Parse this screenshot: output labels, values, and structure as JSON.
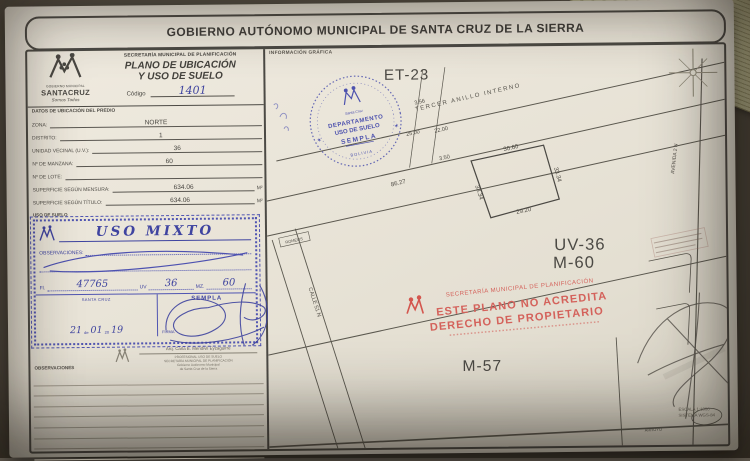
{
  "header": {
    "title": "GOBIERNO AUTÓNOMO MUNICIPAL DE SANTA CRUZ DE LA SIERRA"
  },
  "left": {
    "logo": {
      "org": "GOBIERNO MUNICIPAL",
      "name": "SANTACRUZ",
      "tagline": "Somos Todos"
    },
    "secretary": "SECRETARÍA MUNICIPAL DE PLANIFICACIÓN",
    "title1": "PLANO DE UBICACIÓN",
    "title2": "Y USO DE SUELO",
    "codigo_label": "Código",
    "codigo_value": "1401",
    "datos_label": "DATOS DE UBICACIÓN DEL PREDIO",
    "f_zona_label": "ZONA:",
    "f_zona": "NORTE",
    "f_distrito_label": "DISTRITO:",
    "f_distrito": "1",
    "f_uv_label": "UNIDAD VECINAL (U.V.):",
    "f_uv": "36",
    "f_manzana_label": "Nº DE MANZANA:",
    "f_manzana": "60",
    "f_lote_label": "Nº DE LOTE:",
    "f_lote": "",
    "f_sup_mensura_label": "SUPERFICIE SEGÚN MENSURA:",
    "f_sup_mensura": "634.06",
    "f_sup_mensura_unit": "M²",
    "f_sup_titulo_label": "SUPERFICIE SEGÚN TÍTULO:",
    "f_sup_titulo": "634.06",
    "f_sup_titulo_unit": "M²",
    "uso_label": "USO DE SUELO",
    "stamp": {
      "title": "USO MIXTO",
      "obs_label": "OBSERVACIONES:",
      "fl_label": "Fl.",
      "fl": "47765",
      "uv_label": "UV",
      "uv": "36",
      "mz_label": "MZ.",
      "mz": "60",
      "city": "SANTA CRUZ",
      "office": "SEMPLA",
      "day": "21",
      "de": "de",
      "month": "01",
      "y20": "20",
      "year": "19",
      "firma": "FIRMA"
    },
    "signatory": {
      "name": "Arq. Carla E. Mendivil Eyzaguirre",
      "role": "PROFESIONAL USO DE SUELO",
      "dept": "SECRETARÍA MUNICIPAL DE PLANIFICACIÓN",
      "org1": "Gobierno Autónomo Municipal",
      "org2": "de Santa Cruz de la Sierra"
    },
    "obs_label": "OBSERVACIONES"
  },
  "map": {
    "info_label": "INFORMACIÓN GRÁFICA",
    "et": "ET-23",
    "round_stamp": {
      "l1": "DEPARTAMENTO",
      "l2": "USO DE SUELO",
      "l3": "SEMPLA",
      "l4": "Santa Cruz",
      "l5": "BOLIVIA",
      "star_left": "✶",
      "star_right": "✶"
    },
    "streets": {
      "anillo": "TERCER ANILLO INTERNO",
      "calle": "CALLE 51 N",
      "avenida": "AVENIDA 2 N",
      "ramal": "ROMEOS",
      "arroyo": "ARROYO"
    },
    "blocks": {
      "uv36": "UV-36",
      "m60": "M-60",
      "m57": "M-57"
    },
    "dims": {
      "d356": "3.56",
      "d2500": "25.00",
      "d2200": "22.00",
      "d350": "3.50",
      "d8627": "86.27",
      "p_top": "30.60",
      "p_left": "33.34",
      "p_right": "33.34",
      "p_bottom": "29.20"
    },
    "red_stamp": {
      "arc": "SECRETARÍA MUNICIPAL DE PLANIFICACIÓN",
      "l1": "ESTE PLANO NO ACREDITA",
      "l2": "DERECHO DE PROPIETARIO"
    },
    "scale1": "ESCALA 1:1000",
    "scale2": "SISTEMA WGS-84"
  },
  "colors": {
    "blue_stamp": "#3f44a0",
    "red_stamp": "#d4564e",
    "ink": "#45433e",
    "paper": "#e9e4d8"
  }
}
